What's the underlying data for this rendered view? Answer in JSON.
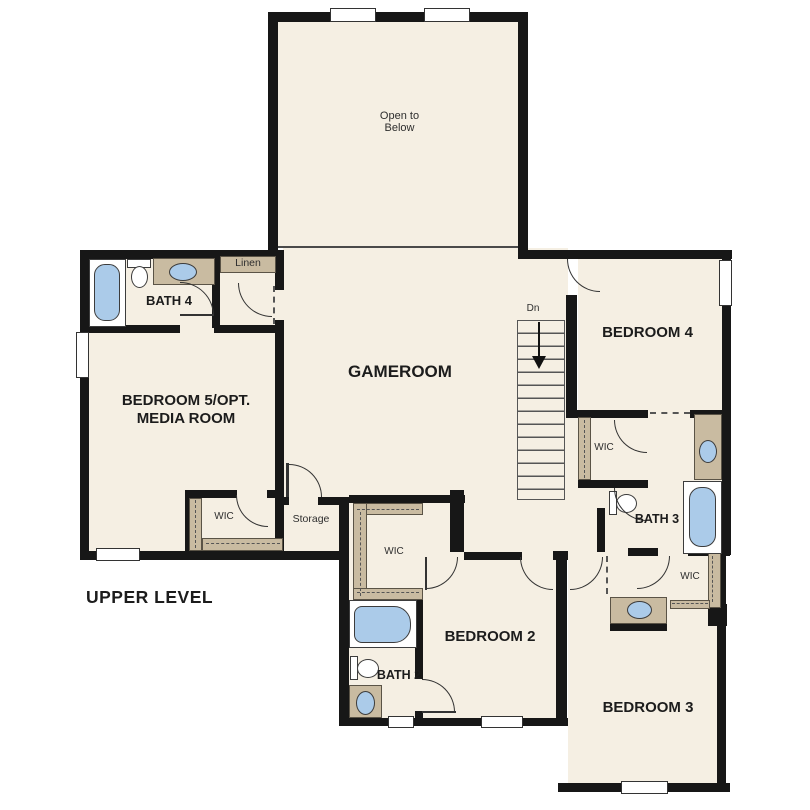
{
  "title": "UPPER LEVEL",
  "labels": {
    "open_below": "Open to Below",
    "gameroom": "GAMEROOM",
    "bedroom5": "BEDROOM 5/OPT. MEDIA ROOM",
    "bedroom4": "BEDROOM 4",
    "bedroom3": "BEDROOM 3",
    "bedroom2": "BEDROOM 2",
    "bath4": "BATH 4",
    "bath3": "BATH 3",
    "bath2": "BATH 2",
    "linen": "Linen",
    "storage": "Storage",
    "wic": "WIC",
    "stairs_down": "Dn"
  },
  "colors": {
    "floor": "#f5efe3",
    "counter": "#c9bba1",
    "fixture": "#abcbe9",
    "wall": "#171717"
  }
}
